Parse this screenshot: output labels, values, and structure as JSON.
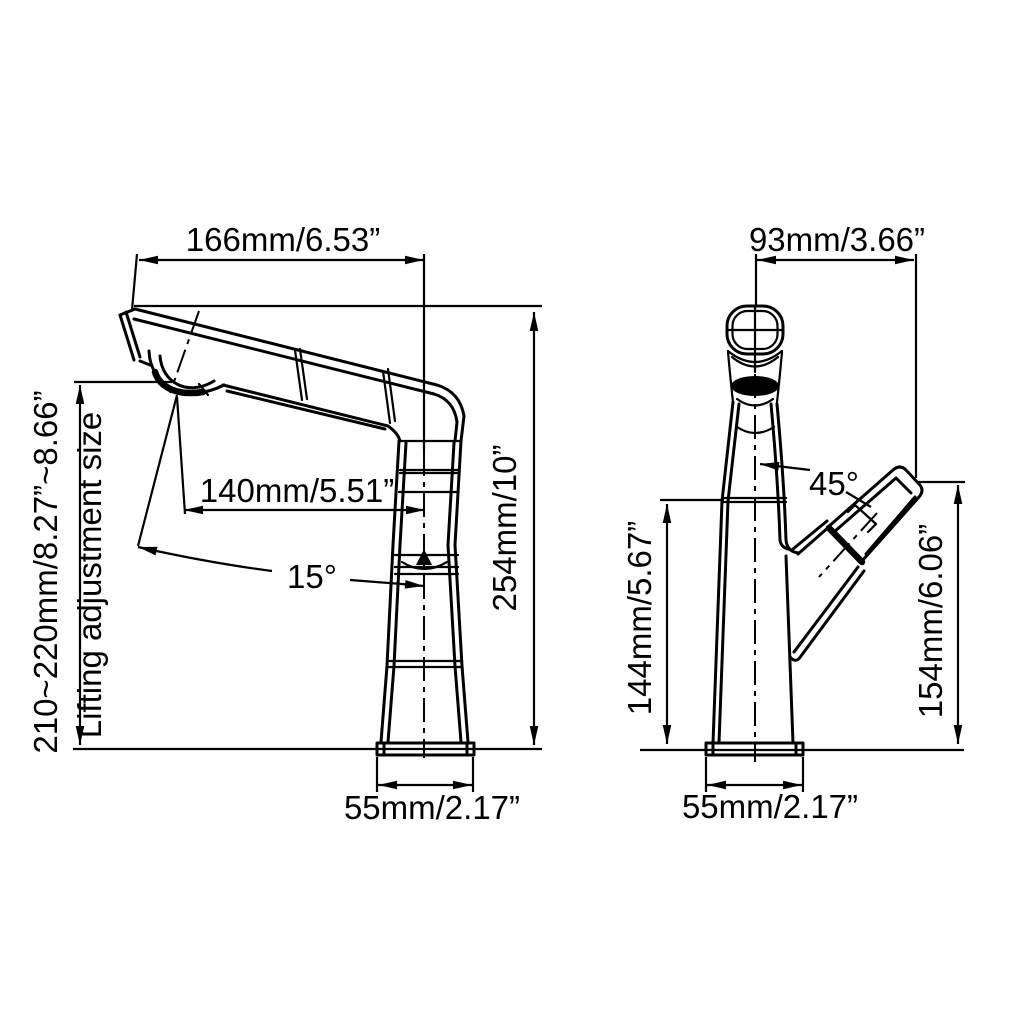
{
  "drawing": {
    "background": "#ffffff",
    "line_color": "#000000",
    "side_view": {
      "spout_width_label": "166mm/6.53”",
      "spout_reach_label": "140mm/5.51”",
      "spout_angle_label": "15°",
      "overall_height_label": "254mm/10”",
      "lifting_range_label": "210~220mm/8.27”~8.66”",
      "lifting_note_label": "Lifting adjustment size",
      "base_width_label": "55mm/2.17”"
    },
    "front_view": {
      "head_offset_label": "93mm/3.66”",
      "handle_angle_label": "45°",
      "body_height_label": "144mm/5.67”",
      "handle_height_label": "154mm/6.06”",
      "base_width_label": "55mm/2.17”"
    }
  }
}
